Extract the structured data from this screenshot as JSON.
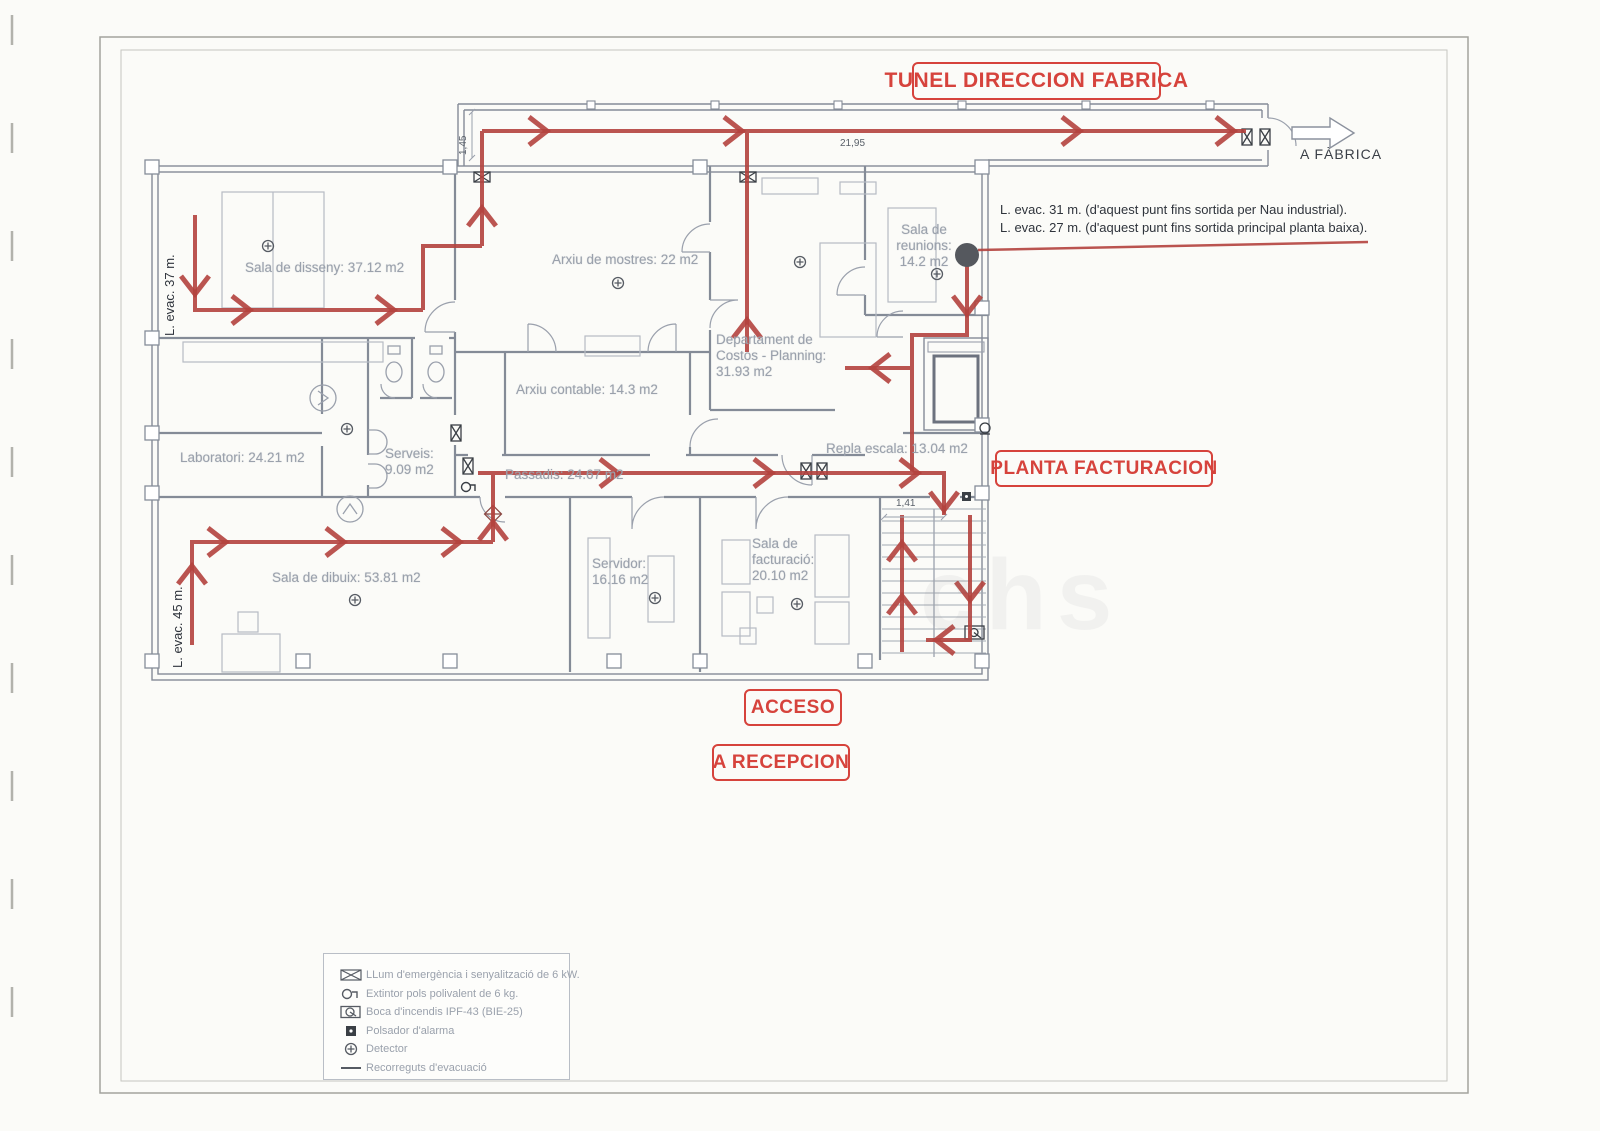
{
  "banners": {
    "tunnel": "TUNEL DIRECCION FABRICA",
    "planta_facturacion": "PLANTA FACTURACION",
    "acceso": "ACCESO",
    "a_recepcion": "A RECEPCION"
  },
  "annotations": {
    "a_fabrica": "A FÀBRICA",
    "evac_note_line1": "L. evac. 31 m. (d'aquest punt fins sortida per Nau industrial).",
    "evac_note_line2": "L. evac. 27 m. (d'aquest punt fins sortida principal planta baixa).",
    "evac_left_top": "L. evac. 37 m.",
    "evac_left_bottom": "L. evac. 45 m.",
    "watermark": "chs"
  },
  "dimensions": {
    "tunnel_width": "1,45",
    "tunnel_length": "21,95",
    "stair_width": "1,41"
  },
  "rooms": [
    {
      "id": "sala-de-disseny",
      "label": "Sala de disseny: 37.12 m2"
    },
    {
      "id": "arxiu-de-mostres",
      "label": "Arxiu de mostres: 22 m2"
    },
    {
      "id": "sala-de-reunions",
      "label": "Sala de reunions: 14.2 m2"
    },
    {
      "id": "departament-costos",
      "label": "Departament de Costos - Planning: 31.93 m2"
    },
    {
      "id": "arxiu-contable",
      "label": "Arxiu contable: 14.3 m2"
    },
    {
      "id": "laboratori",
      "label": "Laboratori: 24.21 m2"
    },
    {
      "id": "serveis",
      "label": "Serveis: 9.09 m2"
    },
    {
      "id": "passadis",
      "label": "Passadis: 24.67 m2"
    },
    {
      "id": "repla-escala",
      "label": "Repla escala: 13.04 m2"
    },
    {
      "id": "sala-de-dibuix",
      "label": "Sala de dibuix: 53.81 m2"
    },
    {
      "id": "servidor",
      "label": "Servidor: 16.16 m2"
    },
    {
      "id": "sala-de-facturacio",
      "label": "Sala de facturació: 20.10 m2"
    }
  ],
  "legend": {
    "items": [
      {
        "icon": "emergency-light-icon",
        "label": "LLum d'emergència i senyalització de 6 kW."
      },
      {
        "icon": "extinguisher-icon",
        "label": "Extintor pols polivalent de 6 kg."
      },
      {
        "icon": "fire-hose-icon",
        "label": "Boca d'incendis IPF-43 (BIE-25)"
      },
      {
        "icon": "alarm-button-icon",
        "label": "Polsador d'alarma"
      },
      {
        "icon": "detector-icon",
        "label": "Detector"
      },
      {
        "icon": "evacuation-route-icon",
        "label": "Recorreguts d'evacuació"
      }
    ]
  },
  "colors": {
    "route_red": "#b4433e",
    "banner_red": "#d6433c",
    "plan_gray": "#848b97",
    "room_text_gray": "#9aa1ac"
  }
}
